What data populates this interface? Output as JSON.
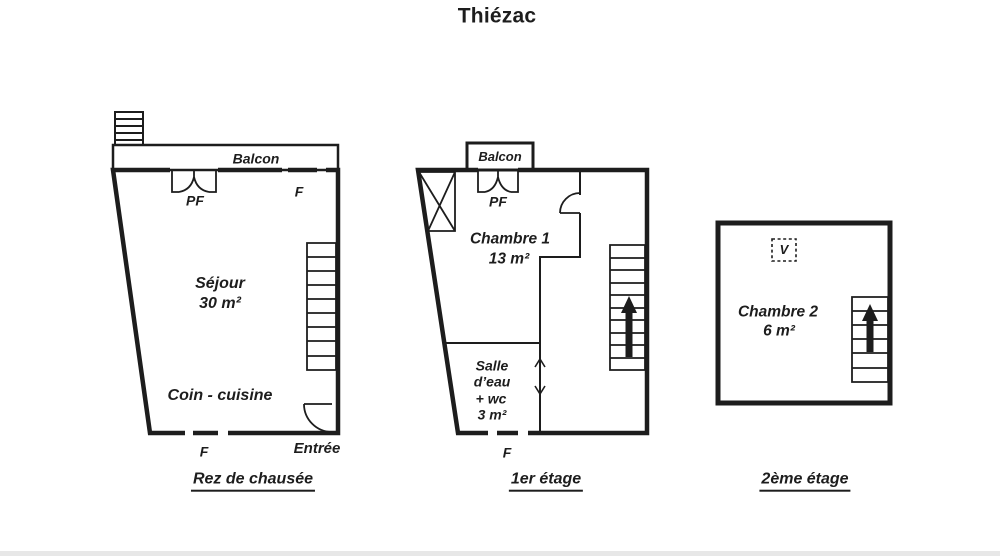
{
  "title": "Thiézac",
  "colors": {
    "line": "#1d1d1d",
    "background": "#ffffff"
  },
  "ground_floor": {
    "label": "Rez de chausée",
    "balcony_label": "Balcon",
    "french_window_label": "PF",
    "window_top_label": "F",
    "living_room_name": "Séjour",
    "living_room_area": "30 m²",
    "kitchen_name": "Coin - cuisine",
    "window_bottom_label": "F",
    "entrance_label": "Entrée"
  },
  "first_floor": {
    "label": "1er étage",
    "balcony_label": "Balcon",
    "french_window_label": "PF",
    "bedroom_name": "Chambre 1",
    "bedroom_area": "13 m²",
    "bathroom_line1": "Salle",
    "bathroom_line2": "d’eau",
    "bathroom_line3": "+ wc",
    "bathroom_line4": "3 m²",
    "window_bottom_label": "F"
  },
  "second_floor": {
    "label": "2ème étage",
    "skylight_label": "V",
    "bedroom_name": "Chambre 2",
    "bedroom_area": "6 m²"
  }
}
